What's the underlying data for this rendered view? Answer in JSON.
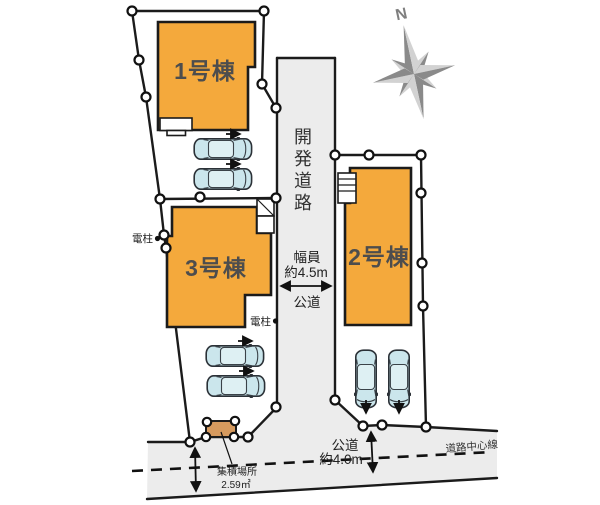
{
  "compass": {
    "north_label": "N"
  },
  "buildings": {
    "unit1": {
      "label": "1号棟"
    },
    "unit2": {
      "label": "2号棟"
    },
    "unit3": {
      "label": "3号棟"
    }
  },
  "road": {
    "development_road": "開発道路",
    "width_caption": "幅員",
    "width_value": "約4.5m",
    "public_road_side": "公道",
    "public_road_bottom": "公道",
    "public_road_bottom_width": "約4.0m",
    "road_center_line": "道路中心線"
  },
  "site": {
    "utility_pole_left": "電柱",
    "utility_pole_right": "電柱",
    "collection_area_name": "集積場所",
    "collection_area_size": "2.59㎡"
  },
  "colors": {
    "building_fill": "#F4A93C",
    "road_fill": "#ECECEC",
    "car_fill": "#CBE6EC",
    "collection_fill": "#D69A5E"
  }
}
